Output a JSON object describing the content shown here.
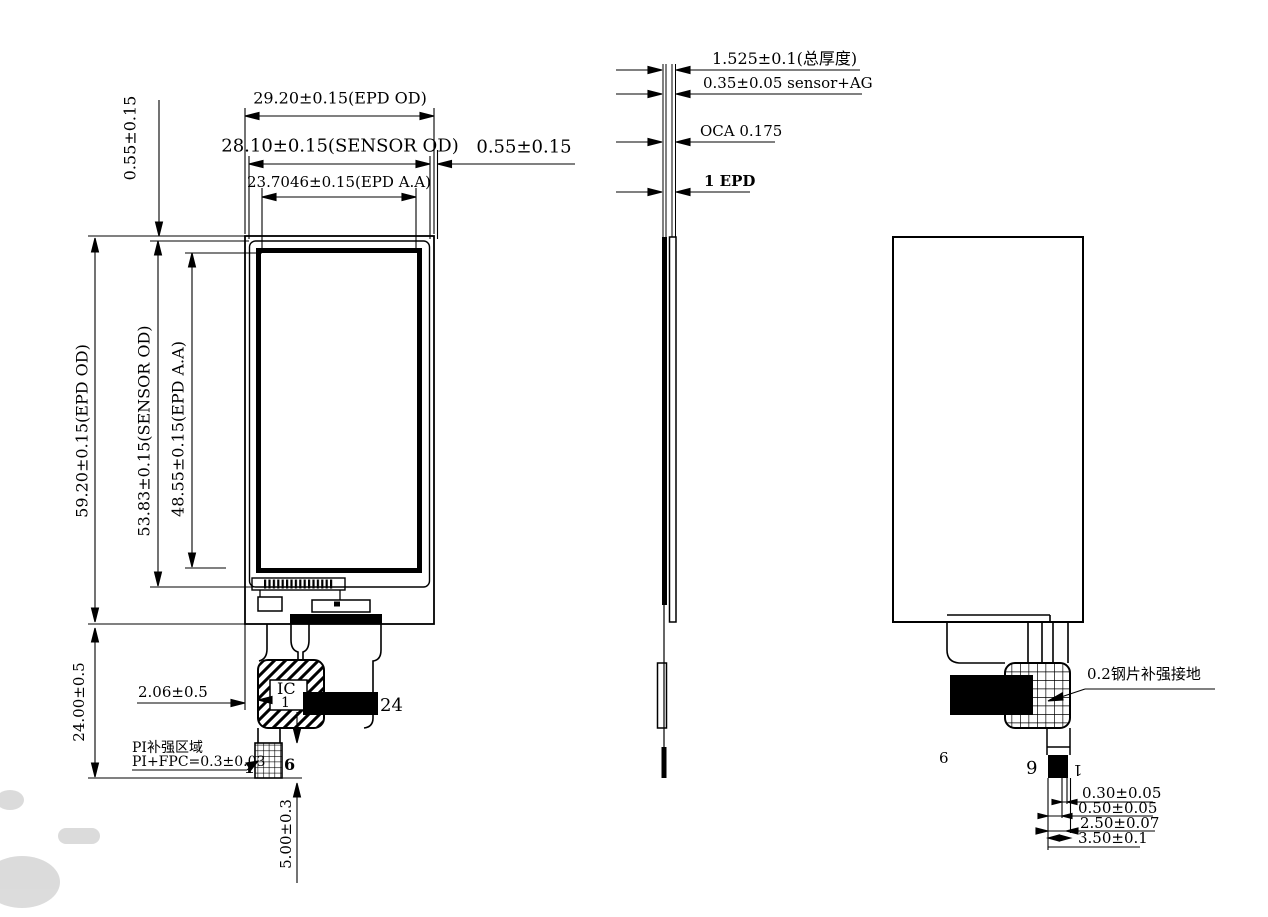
{
  "front_view": {
    "width_epd_od": "29.20±0.15(EPD OD)",
    "width_sensor_od": "28.10±0.15(SENSOR OD)",
    "width_epd_aa": "23.7046±0.15(EPD A.A)",
    "gap_top": "0.55±0.15",
    "gap_right": "0.55±0.15",
    "height_epd_od": "59.20±0.15(EPD OD)",
    "height_sensor_od": "53.83±0.15(SENSOR OD)",
    "height_epd_aa": "48.55±0.15(EPD A.A)",
    "fpc_length": "24.00±0.5",
    "ic_offset": "2.06±0.5",
    "ic_label": "IC",
    "pin_1": "1",
    "pin_24": "24",
    "pi_area_note": "PI补强区域",
    "pi_fpc_thickness": "PI+FPC=0.3±0.03",
    "pi_pin_1": "1",
    "pi_pin_6": "6",
    "tail_length": "5.00±0.3"
  },
  "side_view": {
    "total_thickness": "1.525±0.1(总厚度)",
    "sensor_ag": "0.35±0.05 sensor+AG",
    "oca": "OCA 0.175",
    "epd": "1 EPD"
  },
  "back_view": {
    "steel_note": "0.2钢片补强接地",
    "pin_6_label": "6",
    "pin_6_rotated": "6",
    "pin_1_rotated": "1",
    "dim_1": "0.30±0.05",
    "dim_2": "0.50±0.05",
    "dim_3": "2.50±0.07",
    "dim_4": "3.50±0.1"
  },
  "colors": {
    "line": "#000000",
    "background": "#ffffff"
  }
}
